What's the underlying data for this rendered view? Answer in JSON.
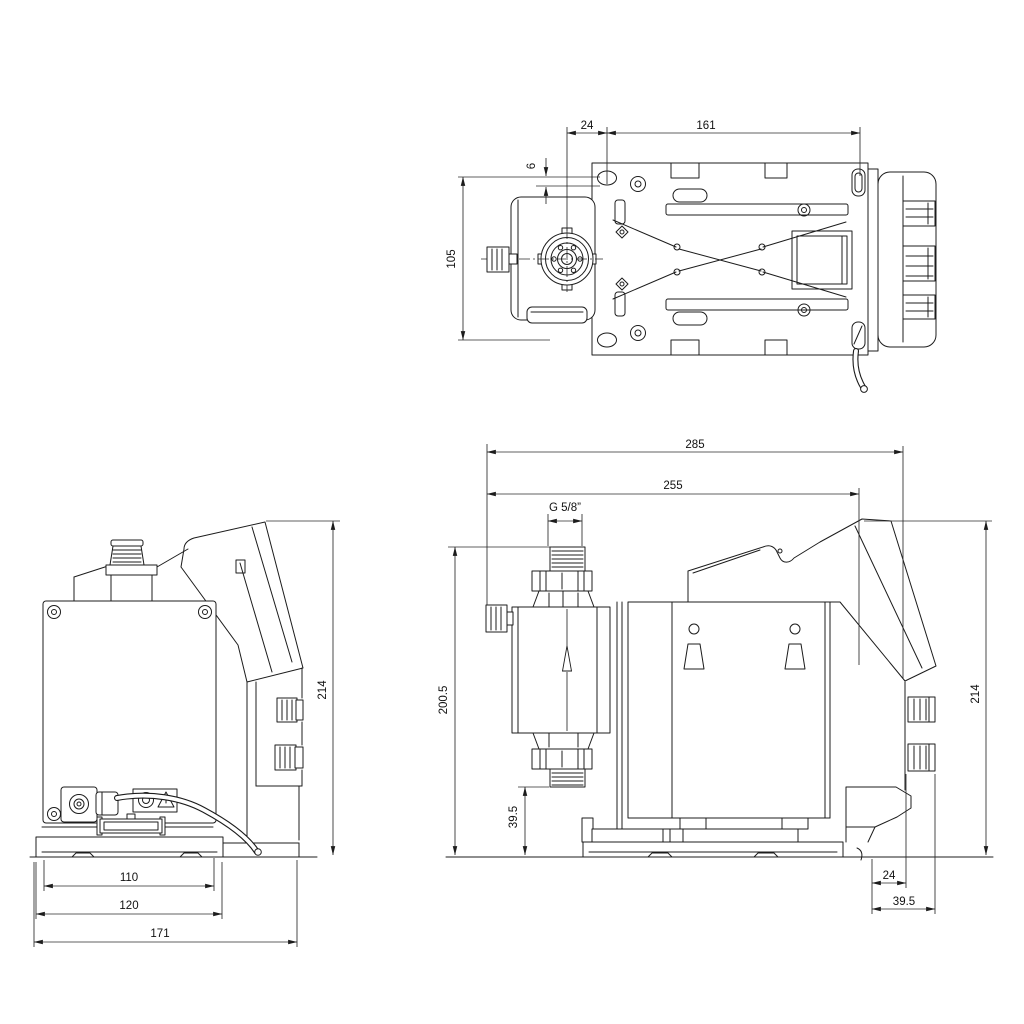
{
  "colors": {
    "background": "#ffffff",
    "line": "#1c1c1c"
  },
  "views": {
    "top": {
      "dims": {
        "d24": "24",
        "d161": "161",
        "d6": "6",
        "d105": "105"
      }
    },
    "back": {
      "dims": {
        "d214": "214",
        "d110": "110",
        "d120": "120",
        "d171": "171"
      }
    },
    "side": {
      "dims": {
        "d285": "285",
        "d255": "255",
        "thread": "G 5/8”",
        "d200_5": "200.5",
        "d39_5_port": "39.5",
        "d214": "214",
        "d24": "24",
        "d39_5_gland": "39.5"
      }
    }
  }
}
